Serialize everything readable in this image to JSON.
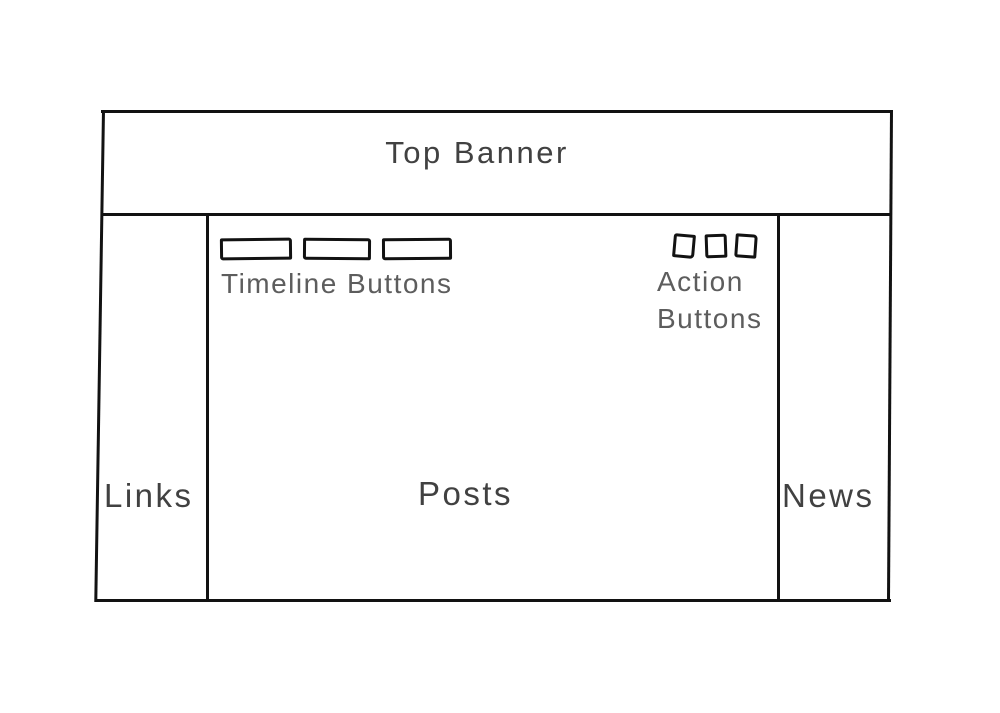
{
  "wireframe": {
    "banner": {
      "label": "Top Banner"
    },
    "left_sidebar": {
      "label": "Links"
    },
    "content": {
      "label": "Posts",
      "timeline": {
        "label": "Timeline Buttons",
        "button_count": 3
      },
      "actions": {
        "label_line1": "Action",
        "label_line2": "Buttons",
        "button_count": 3
      }
    },
    "right_sidebar": {
      "label": "News"
    },
    "colors": {
      "stroke": "#121212",
      "heading_text": "#414141",
      "caption_text": "#5d5d5d",
      "background": "#ffffff"
    }
  }
}
